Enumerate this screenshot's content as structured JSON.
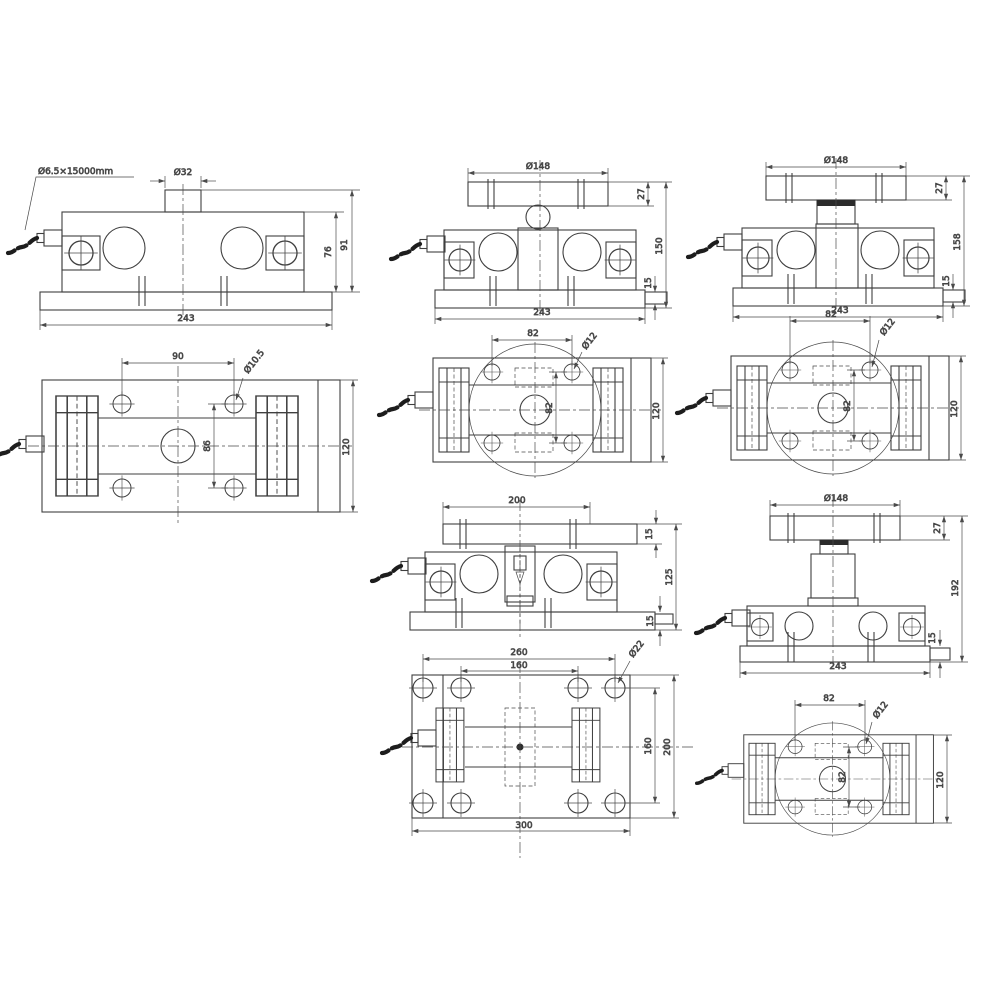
{
  "drawing": {
    "background": "#ffffff",
    "ink": "#3f3f3f",
    "views": {
      "loadcell_side": {
        "cable_spec": "Ø6.5×15000mm",
        "boss_diameter": "Ø32",
        "base_width": "243",
        "body_height": "76",
        "overall_height": "91"
      },
      "loadcell_top": {
        "hole_pitch": "90",
        "hole_diameter": "Ø10.5",
        "hole_row_pitch": "86",
        "plate_width": "120"
      },
      "mount_ball_side": {
        "top_plate_diameter": "Ø148",
        "top_plate_thickness": "27",
        "overall_height": "150",
        "foot_thickness": "15",
        "base_width": "243"
      },
      "mount_ball_plan": {
        "hole_pitch_x": "82",
        "hole_diameter": "Ø12",
        "hole_pitch_y": "82",
        "plate_width": "120"
      },
      "mount_cup_side": {
        "top_plate_diameter": "Ø148",
        "top_plate_thickness": "27",
        "overall_height": "158",
        "foot_thickness": "15",
        "base_width": "243"
      },
      "mount_cup_plan": {
        "hole_pitch_x": "82",
        "hole_diameter": "Ø12",
        "hole_pitch_y": "82",
        "plate_width": "120"
      },
      "mount_pin_side": {
        "top_plate_width": "200",
        "top_plate_thickness": "15",
        "overall_height": "125",
        "foot_thickness": "15"
      },
      "mount_pin_base_plan": {
        "bolt_pitch_outer": "260",
        "bolt_pitch_inner": "160",
        "hole_diameter": "Ø22",
        "bolt_row_pitch": "160",
        "plate_depth": "200",
        "plate_width": "300"
      },
      "mount_column_side": {
        "top_plate_diameter": "Ø148",
        "top_plate_thickness": "27",
        "overall_height": "192",
        "foot_thickness": "15",
        "base_width": "243"
      },
      "mount_column_plan": {
        "hole_pitch_x": "82",
        "hole_diameter": "Ø12",
        "hole_pitch_y": "82",
        "plate_width": "120"
      }
    }
  }
}
